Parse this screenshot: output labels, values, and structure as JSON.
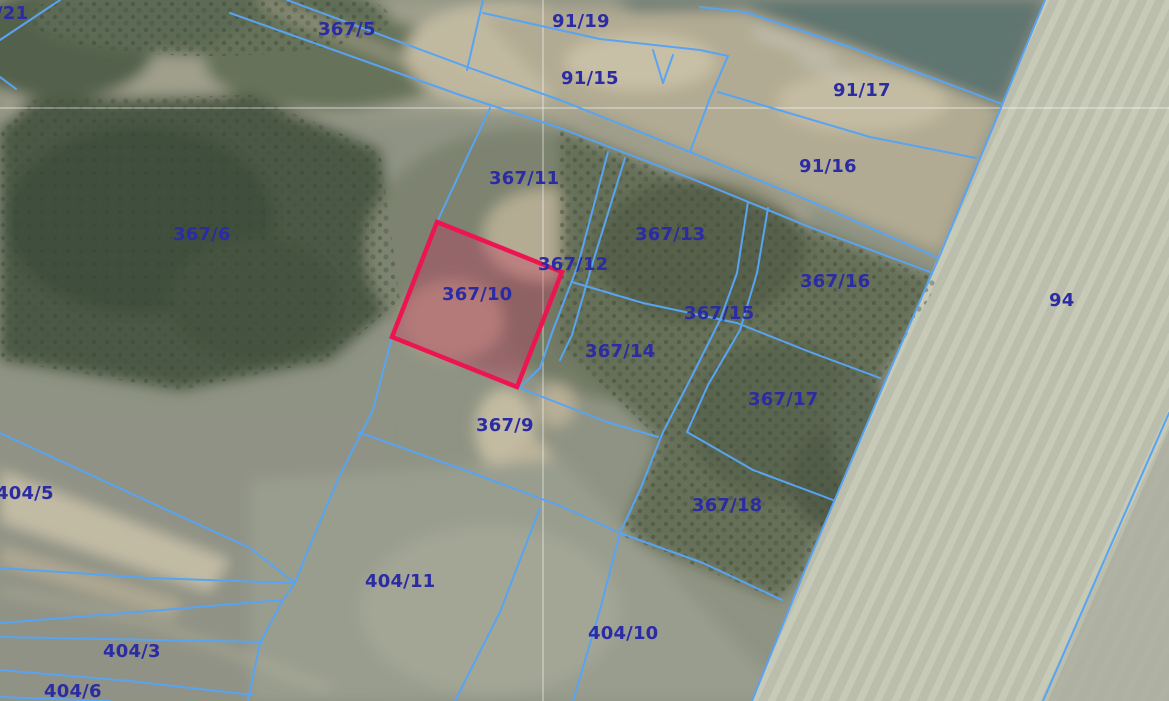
{
  "map": {
    "type": "cadastral-aerial-view",
    "colors": {
      "boundary": "#58a4f2",
      "label": "#2b2ba3",
      "highlight_stroke": "#ec1551",
      "highlight_fill": "rgba(205,35,90,0.30)",
      "grid": "rgba(255,255,255,0.5)"
    },
    "highlighted_parcel": {
      "id": "367/10",
      "points": "437,222 562,272 517,387 392,337"
    },
    "grid": {
      "horizontal_y": 108,
      "vertical_x": 543
    },
    "labels": [
      {
        "id": "21",
        "text": "/21",
        "x": -4,
        "y": 3
      },
      {
        "id": "367-5",
        "text": "367/5",
        "x": 318,
        "y": 19
      },
      {
        "id": "91-19",
        "text": "91/19",
        "x": 552,
        "y": 11
      },
      {
        "id": "91-15",
        "text": "91/15",
        "x": 561,
        "y": 68
      },
      {
        "id": "91-17",
        "text": "91/17",
        "x": 833,
        "y": 80
      },
      {
        "id": "91-16",
        "text": "91/16",
        "x": 799,
        "y": 156
      },
      {
        "id": "367-11",
        "text": "367/11",
        "x": 489,
        "y": 168
      },
      {
        "id": "367-6",
        "text": "367/6",
        "x": 173,
        "y": 224
      },
      {
        "id": "367-13",
        "text": "367/13",
        "x": 635,
        "y": 224
      },
      {
        "id": "367-12",
        "text": "367/12",
        "x": 538,
        "y": 254
      },
      {
        "id": "367-16",
        "text": "367/16",
        "x": 800,
        "y": 271
      },
      {
        "id": "367-10",
        "text": "367/10",
        "x": 442,
        "y": 284
      },
      {
        "id": "367-15",
        "text": "367/15",
        "x": 684,
        "y": 303
      },
      {
        "id": "94",
        "text": "94",
        "x": 1049,
        "y": 290
      },
      {
        "id": "367-14",
        "text": "367/14",
        "x": 585,
        "y": 341
      },
      {
        "id": "367-17",
        "text": "367/17",
        "x": 748,
        "y": 389
      },
      {
        "id": "367-9",
        "text": "367/9",
        "x": 476,
        "y": 415
      },
      {
        "id": "404-5",
        "text": "404/5",
        "x": -4,
        "y": 483
      },
      {
        "id": "367-18",
        "text": "367/18",
        "x": 692,
        "y": 495
      },
      {
        "id": "404-11",
        "text": "404/11",
        "x": 365,
        "y": 571
      },
      {
        "id": "404-10",
        "text": "404/10",
        "x": 588,
        "y": 623
      },
      {
        "id": "404-3",
        "text": "404/3",
        "x": 103,
        "y": 641
      },
      {
        "id": "404-6",
        "text": "404/6",
        "x": 44,
        "y": 681
      }
    ]
  }
}
